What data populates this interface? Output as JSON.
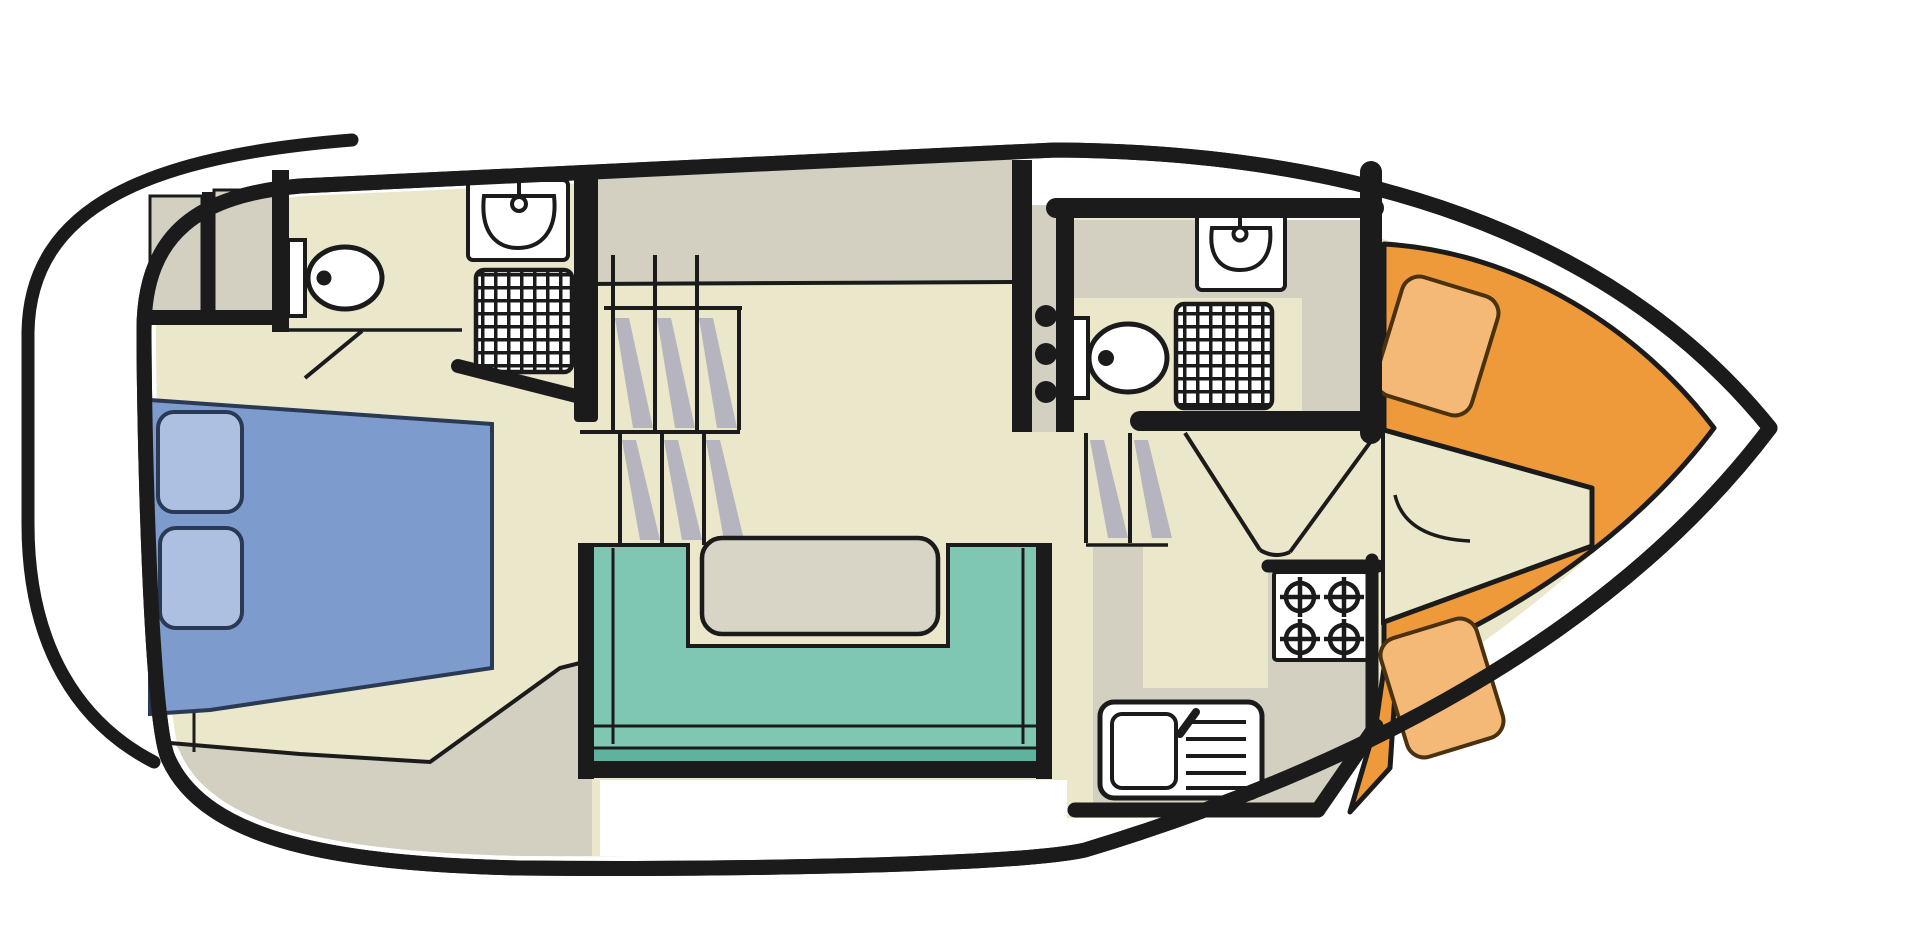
{
  "page": {
    "background": "#ffffff",
    "description_semantic": "boat-deck-floor-plan"
  },
  "colors": {
    "page_background": "#ffffff",
    "line_black": "#1b1b1b",
    "hull_white": "#ffffff",
    "floor_beige": "#eae7ca",
    "cabinet_grey": "#d3d0c2",
    "hatch_grey": "#b6b4bf",
    "seat_teal": "#7fc7b2",
    "seat_teal_dark": "#5fb29d",
    "bed_blue": "#7e9bce",
    "pillow_blue": "#adc0e1",
    "bed_outline": "#2a3a55",
    "berth_orange": "#ee9a3b",
    "cushion_orange": "#f4b877",
    "cushion_outline": "#4a320e",
    "table_grey": "#d8d5c7",
    "fixture_white": "#ffffff"
  },
  "semantics": {
    "regions": [
      "swim-platform",
      "aft-double-cabin",
      "aft-bathroom",
      "companionway-stairs-aft",
      "saloon",
      "companionway-stairs-bow",
      "galley",
      "mid-bathroom",
      "bow-v-berth-cabin",
      "side-decks"
    ],
    "fixtures": [
      "double-bed",
      "pillows",
      "wardrobes",
      "toilet-icon",
      "washbasin-icon",
      "shower-grid-icon",
      "saloon-table",
      "u-shaped-seating",
      "stove-4-burner-icon",
      "galley-sink-icon",
      "v-berth-cushions",
      "door-swing-lines"
    ]
  }
}
